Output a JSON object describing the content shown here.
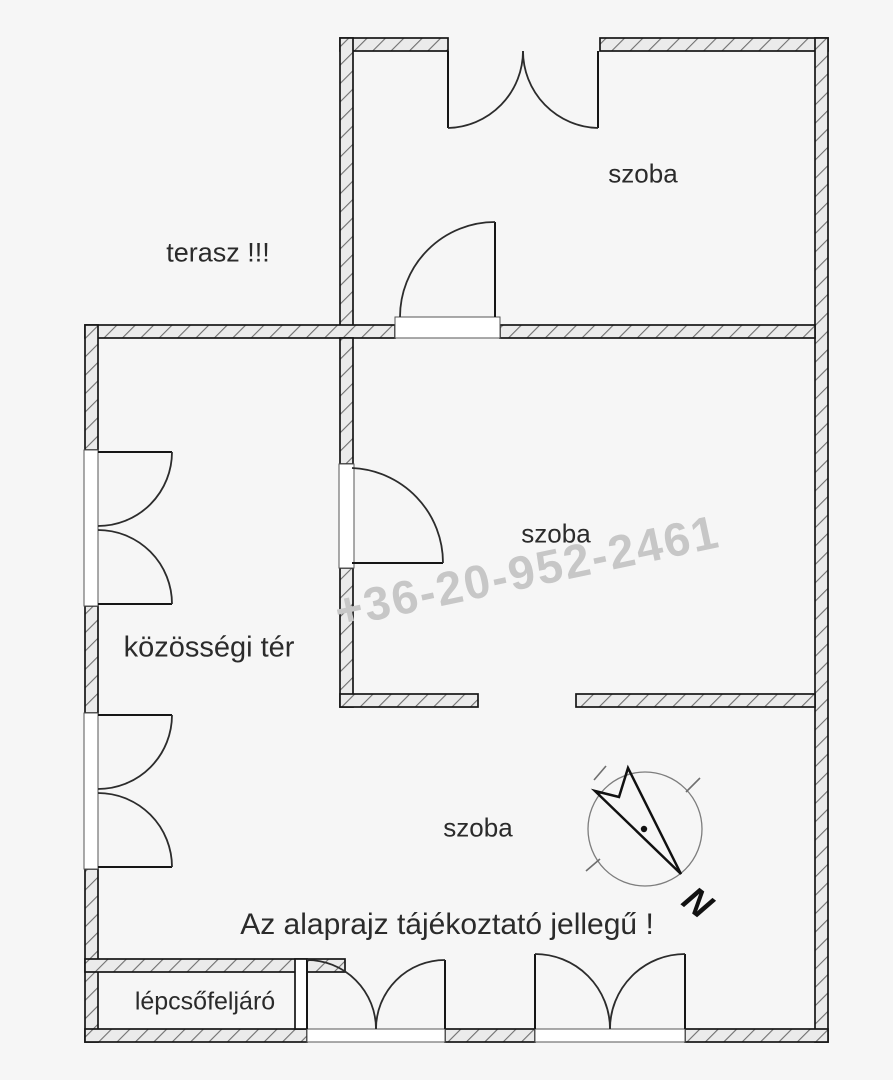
{
  "colors": {
    "background": "#f6f6f6",
    "line": "#161616",
    "text": "#2b2b2b",
    "watermark": "#c7c7c7"
  },
  "plan": {
    "rooms": [
      {
        "id": "room-top",
        "label": "szoba"
      },
      {
        "id": "terrace",
        "label": "terasz !!!"
      },
      {
        "id": "room-middle",
        "label": "szoba"
      },
      {
        "id": "common-area",
        "label": "közösségi tér"
      },
      {
        "id": "room-bottom",
        "label": "szoba"
      },
      {
        "id": "staircase",
        "label": "lépcsőfeljáró"
      }
    ],
    "disclaimer": "Az alaprajz tájékoztató jellegű !",
    "watermark_phone": "+36-20-952-2461",
    "compass": {
      "north_label": "N"
    }
  }
}
